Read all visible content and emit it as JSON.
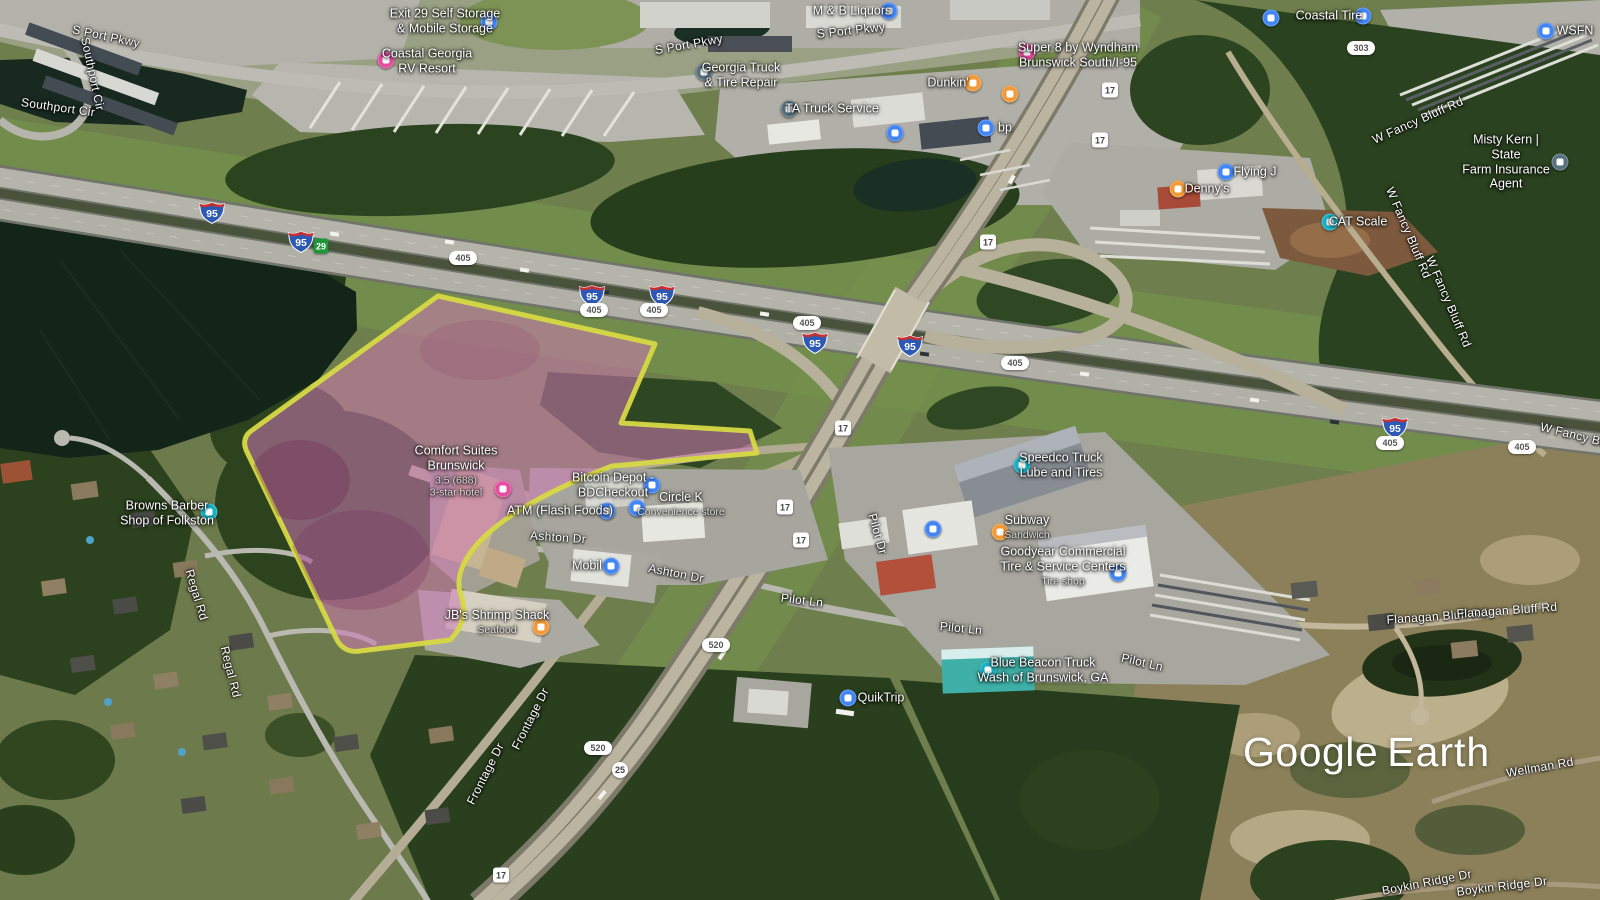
{
  "app": {
    "name": "Google Earth"
  },
  "watermark": {
    "google": "Google",
    "earth": "Earth"
  },
  "colors": {
    "poi_blue": "#4285f4",
    "poi_pink": "#e64ca0",
    "poi_orange": "#f29a38",
    "poi_teal": "#16b2c5",
    "poi_slate": "#57717e",
    "shield_interstate_blue": "#2d59b5",
    "shield_interstate_red": "#c62f33",
    "exit_green": "#1e9639"
  },
  "parcel": {
    "description": "highlighted land parcel",
    "fill_color": "#cd78b4",
    "stroke_color": "#d6d943"
  },
  "road_labels": [
    {
      "text": "S Port Pkwy",
      "x": 106,
      "y": 37,
      "r": 12
    },
    {
      "text": "Southport Cir",
      "x": 92,
      "y": 74,
      "r": 78
    },
    {
      "text": "Southport Cir",
      "x": 58,
      "y": 108,
      "r": 8
    },
    {
      "text": "S Port Pkwy",
      "x": 689,
      "y": 45,
      "r": -10
    },
    {
      "text": "S Port Pkwy",
      "x": 851,
      "y": 31,
      "r": -6
    },
    {
      "text": "W Fancy Bluff Rd",
      "x": 1418,
      "y": 121,
      "r": -24
    },
    {
      "text": "W Fancy Bluff Rd",
      "x": 1408,
      "y": 233,
      "r": 67
    },
    {
      "text": "W Fancy Bluff Rd",
      "x": 1448,
      "y": 302,
      "r": 67
    },
    {
      "text": "W Fancy Bluff Rd",
      "x": 1588,
      "y": 439,
      "r": 14
    },
    {
      "text": "Ashton Dr",
      "x": 558,
      "y": 538,
      "r": 4
    },
    {
      "text": "Ashton Dr",
      "x": 676,
      "y": 574,
      "r": 11
    },
    {
      "text": "Regal Rd",
      "x": 196,
      "y": 595,
      "r": 73
    },
    {
      "text": "Regal Rd",
      "x": 230,
      "y": 672,
      "r": 76
    },
    {
      "text": "Pilot Dr",
      "x": 877,
      "y": 534,
      "r": 74
    },
    {
      "text": "Pilot Ln",
      "x": 802,
      "y": 601,
      "r": 7
    },
    {
      "text": "Pilot Ln",
      "x": 961,
      "y": 629,
      "r": 6
    },
    {
      "text": "Pilot Ln",
      "x": 1142,
      "y": 663,
      "r": 13
    },
    {
      "text": "Frontage Dr",
      "x": 531,
      "y": 719,
      "r": -63
    },
    {
      "text": "Frontage Dr",
      "x": 486,
      "y": 774,
      "r": -63
    },
    {
      "text": "Flanagan Bluff Rd",
      "x": 1437,
      "y": 617,
      "r": -4
    },
    {
      "text": "Flanagan Bluff Rd",
      "x": 1507,
      "y": 611,
      "r": -4
    },
    {
      "text": "Wellman Rd",
      "x": 1540,
      "y": 768,
      "r": -10
    },
    {
      "text": "Boykin Ridge Dr",
      "x": 1427,
      "y": 883,
      "r": -11
    },
    {
      "text": "Boykin Ridge Dr",
      "x": 1502,
      "y": 887,
      "r": -7
    }
  ],
  "pois": [
    {
      "name": "exit-29-self-storage",
      "label": "Exit 29 Self Storage\n& Mobile Storage",
      "sub": "",
      "lx": 445,
      "ly": 21,
      "icon": "blue",
      "ix": 489,
      "iy": 22
    },
    {
      "name": "coastal-georgia-rv-resort",
      "label": "Coastal Georgia\nRV Resort",
      "sub": "",
      "lx": 427,
      "ly": 61,
      "icon": "pink",
      "ix": 386,
      "iy": 60
    },
    {
      "name": "m-and-b-liquors",
      "label": "M & B Liquors",
      "sub": "",
      "lx": 852,
      "ly": 11,
      "icon": "blue",
      "ix": 889,
      "iy": 11
    },
    {
      "name": "georgia-truck-and-tire-repair",
      "label": "Georgia Truck\n& Tire Repair",
      "sub": "",
      "lx": 741,
      "ly": 75,
      "icon": "slate",
      "ix": 704,
      "iy": 72
    },
    {
      "name": "ta-truck-service",
      "label": "TA Truck Service",
      "sub": "",
      "lx": 832,
      "ly": 109,
      "icon": "slate",
      "ix": 789,
      "iy": 109
    },
    {
      "name": "super-8-by-wyndham",
      "label": "Super 8 by Wyndham\nBrunswick South/I-95",
      "sub": "",
      "lx": 1078,
      "ly": 55,
      "icon": "pink",
      "ix": 1027,
      "iy": 52
    },
    {
      "name": "dunkin",
      "label": "Dunkin'",
      "sub": "",
      "lx": 948,
      "ly": 83,
      "icon": "orange",
      "ix": 973,
      "iy": 83
    },
    {
      "name": "restaurant-poi",
      "label": "",
      "sub": "",
      "lx": 0,
      "ly": 0,
      "icon": "orange",
      "ix": 1010,
      "iy": 94
    },
    {
      "name": "bp",
      "label": "bp",
      "sub": "",
      "lx": 1005,
      "ly": 128,
      "icon": "blue",
      "ix": 986,
      "iy": 128
    },
    {
      "name": "fuel-poi",
      "label": "",
      "sub": "",
      "lx": 0,
      "ly": 0,
      "icon": "blue",
      "ix": 895,
      "iy": 133
    },
    {
      "name": "coastal-tire",
      "label": "Coastal Tire",
      "sub": "",
      "lx": 1329,
      "ly": 16,
      "icon": "blue",
      "ix": 1363,
      "iy": 16
    },
    {
      "name": "parking-poi",
      "label": "",
      "sub": "",
      "lx": 0,
      "ly": 0,
      "icon": "blue",
      "ix": 1271,
      "iy": 18
    },
    {
      "name": "wsfn",
      "label": "WSFN",
      "sub": "",
      "lx": 1575,
      "ly": 31,
      "icon": "blue",
      "ix": 1546,
      "iy": 31
    },
    {
      "name": "misty-kern-state-farm",
      "label": "Misty Kern | State\nFarm Insurance Agent",
      "sub": "",
      "lx": 1506,
      "ly": 162,
      "icon": "slate",
      "ix": 1560,
      "iy": 162
    },
    {
      "name": "flying-j",
      "label": "Flying J",
      "sub": "",
      "lx": 1255,
      "ly": 172,
      "icon": "blue",
      "ix": 1226,
      "iy": 172
    },
    {
      "name": "dennys",
      "label": "Denny's",
      "sub": "",
      "lx": 1207,
      "ly": 189,
      "icon": "orange",
      "ix": 1178,
      "iy": 189
    },
    {
      "name": "cat-scale",
      "label": "CAT Scale",
      "sub": "",
      "lx": 1358,
      "ly": 222,
      "icon": "teal",
      "ix": 1330,
      "iy": 222
    },
    {
      "name": "browns-barber-shop",
      "label": "Browns Barber\nShop of Folkston",
      "sub": "",
      "lx": 167,
      "ly": 513,
      "icon": "teal",
      "ix": 209,
      "iy": 512
    },
    {
      "name": "comfort-suites-brunswick",
      "label": "Comfort Suites\nBrunswick",
      "sub": "3.5 (688)\n3-star hotel",
      "lx": 456,
      "ly": 471,
      "icon": "pink",
      "ix": 503,
      "iy": 489
    },
    {
      "name": "bitcoin-depot-bdcheckout",
      "label": "Bitcoin Depot -\nBDCheckout",
      "sub": "",
      "lx": 613,
      "ly": 485,
      "icon": "blue",
      "ix": 652,
      "iy": 485
    },
    {
      "name": "atm-flash-foods",
      "label": "ATM (Flash Foods)",
      "sub": "",
      "lx": 560,
      "ly": 511,
      "icon": "blue",
      "ix": 607,
      "iy": 511
    },
    {
      "name": "circle-k",
      "label": "Circle K",
      "sub": "Convenience store",
      "lx": 681,
      "ly": 504,
      "icon": "blue",
      "ix": 637,
      "iy": 508
    },
    {
      "name": "mobil",
      "label": "Mobil",
      "sub": "",
      "lx": 587,
      "ly": 566,
      "icon": "blue",
      "ix": 611,
      "iy": 566
    },
    {
      "name": "jbs-shrimp-shack",
      "label": "JB's Shrimp Shack",
      "sub": "Seafood",
      "lx": 497,
      "ly": 622,
      "icon": "orange",
      "ix": 541,
      "iy": 627
    },
    {
      "name": "speedco-truck-lube",
      "label": "Speedco Truck\nLube and Tires",
      "sub": "",
      "lx": 1061,
      "ly": 465,
      "icon": "teal",
      "ix": 1022,
      "iy": 465
    },
    {
      "name": "subway",
      "label": "Subway",
      "sub": "Sandwich",
      "lx": 1027,
      "ly": 527,
      "icon": "orange",
      "ix": 1000,
      "iy": 532
    },
    {
      "name": "fuel-poi-2",
      "label": "",
      "sub": "",
      "lx": 0,
      "ly": 0,
      "icon": "blue",
      "ix": 933,
      "iy": 529
    },
    {
      "name": "goodyear-commercial-tire",
      "label": "Goodyear Commercial\nTire & Service Centers",
      "sub": "Tire shop",
      "lx": 1063,
      "ly": 566,
      "icon": "blue",
      "ix": 1118,
      "iy": 573
    },
    {
      "name": "blue-beacon-truck-wash",
      "label": "Blue Beacon Truck\nWash of Brunswick, GA",
      "sub": "",
      "lx": 1043,
      "ly": 670,
      "icon": "teal",
      "ix": 988,
      "iy": 670
    },
    {
      "name": "quiktrip",
      "label": "QuikTrip",
      "sub": "",
      "lx": 881,
      "ly": 698,
      "icon": "blue",
      "ix": 848,
      "iy": 698
    }
  ],
  "shields": [
    {
      "kind": "interstate",
      "text": "95",
      "x": 212,
      "y": 212
    },
    {
      "kind": "interstate",
      "text": "95",
      "x": 301,
      "y": 241
    },
    {
      "kind": "interstate",
      "text": "95",
      "x": 592,
      "y": 295
    },
    {
      "kind": "interstate",
      "text": "95",
      "x": 662,
      "y": 295
    },
    {
      "kind": "interstate",
      "text": "95",
      "x": 815,
      "y": 342
    },
    {
      "kind": "interstate",
      "text": "95",
      "x": 910,
      "y": 345
    },
    {
      "kind": "interstate",
      "text": "95",
      "x": 1395,
      "y": 427
    },
    {
      "kind": "exit",
      "text": "29",
      "x": 321,
      "y": 246
    },
    {
      "kind": "oval",
      "text": "405",
      "x": 463,
      "y": 258
    },
    {
      "kind": "oval",
      "text": "405",
      "x": 594,
      "y": 310
    },
    {
      "kind": "oval",
      "text": "405",
      "x": 654,
      "y": 310
    },
    {
      "kind": "oval",
      "text": "405",
      "x": 807,
      "y": 323
    },
    {
      "kind": "oval",
      "text": "405",
      "x": 1015,
      "y": 363
    },
    {
      "kind": "oval",
      "text": "405",
      "x": 1390,
      "y": 443
    },
    {
      "kind": "oval",
      "text": "405",
      "x": 1522,
      "y": 447
    },
    {
      "kind": "oval",
      "text": "303",
      "x": 1361,
      "y": 48
    },
    {
      "kind": "oval",
      "text": "520",
      "x": 716,
      "y": 645
    },
    {
      "kind": "oval",
      "text": "520",
      "x": 598,
      "y": 748
    },
    {
      "kind": "square",
      "text": "17",
      "x": 1110,
      "y": 90
    },
    {
      "kind": "square",
      "text": "17",
      "x": 1100,
      "y": 140
    },
    {
      "kind": "square",
      "text": "17",
      "x": 988,
      "y": 242
    },
    {
      "kind": "square",
      "text": "17",
      "x": 843,
      "y": 428
    },
    {
      "kind": "square",
      "text": "17",
      "x": 785,
      "y": 507
    },
    {
      "kind": "square",
      "text": "17",
      "x": 801,
      "y": 540
    },
    {
      "kind": "square",
      "text": "17",
      "x": 501,
      "y": 875
    },
    {
      "kind": "circle",
      "text": "25",
      "x": 620,
      "y": 770
    }
  ]
}
